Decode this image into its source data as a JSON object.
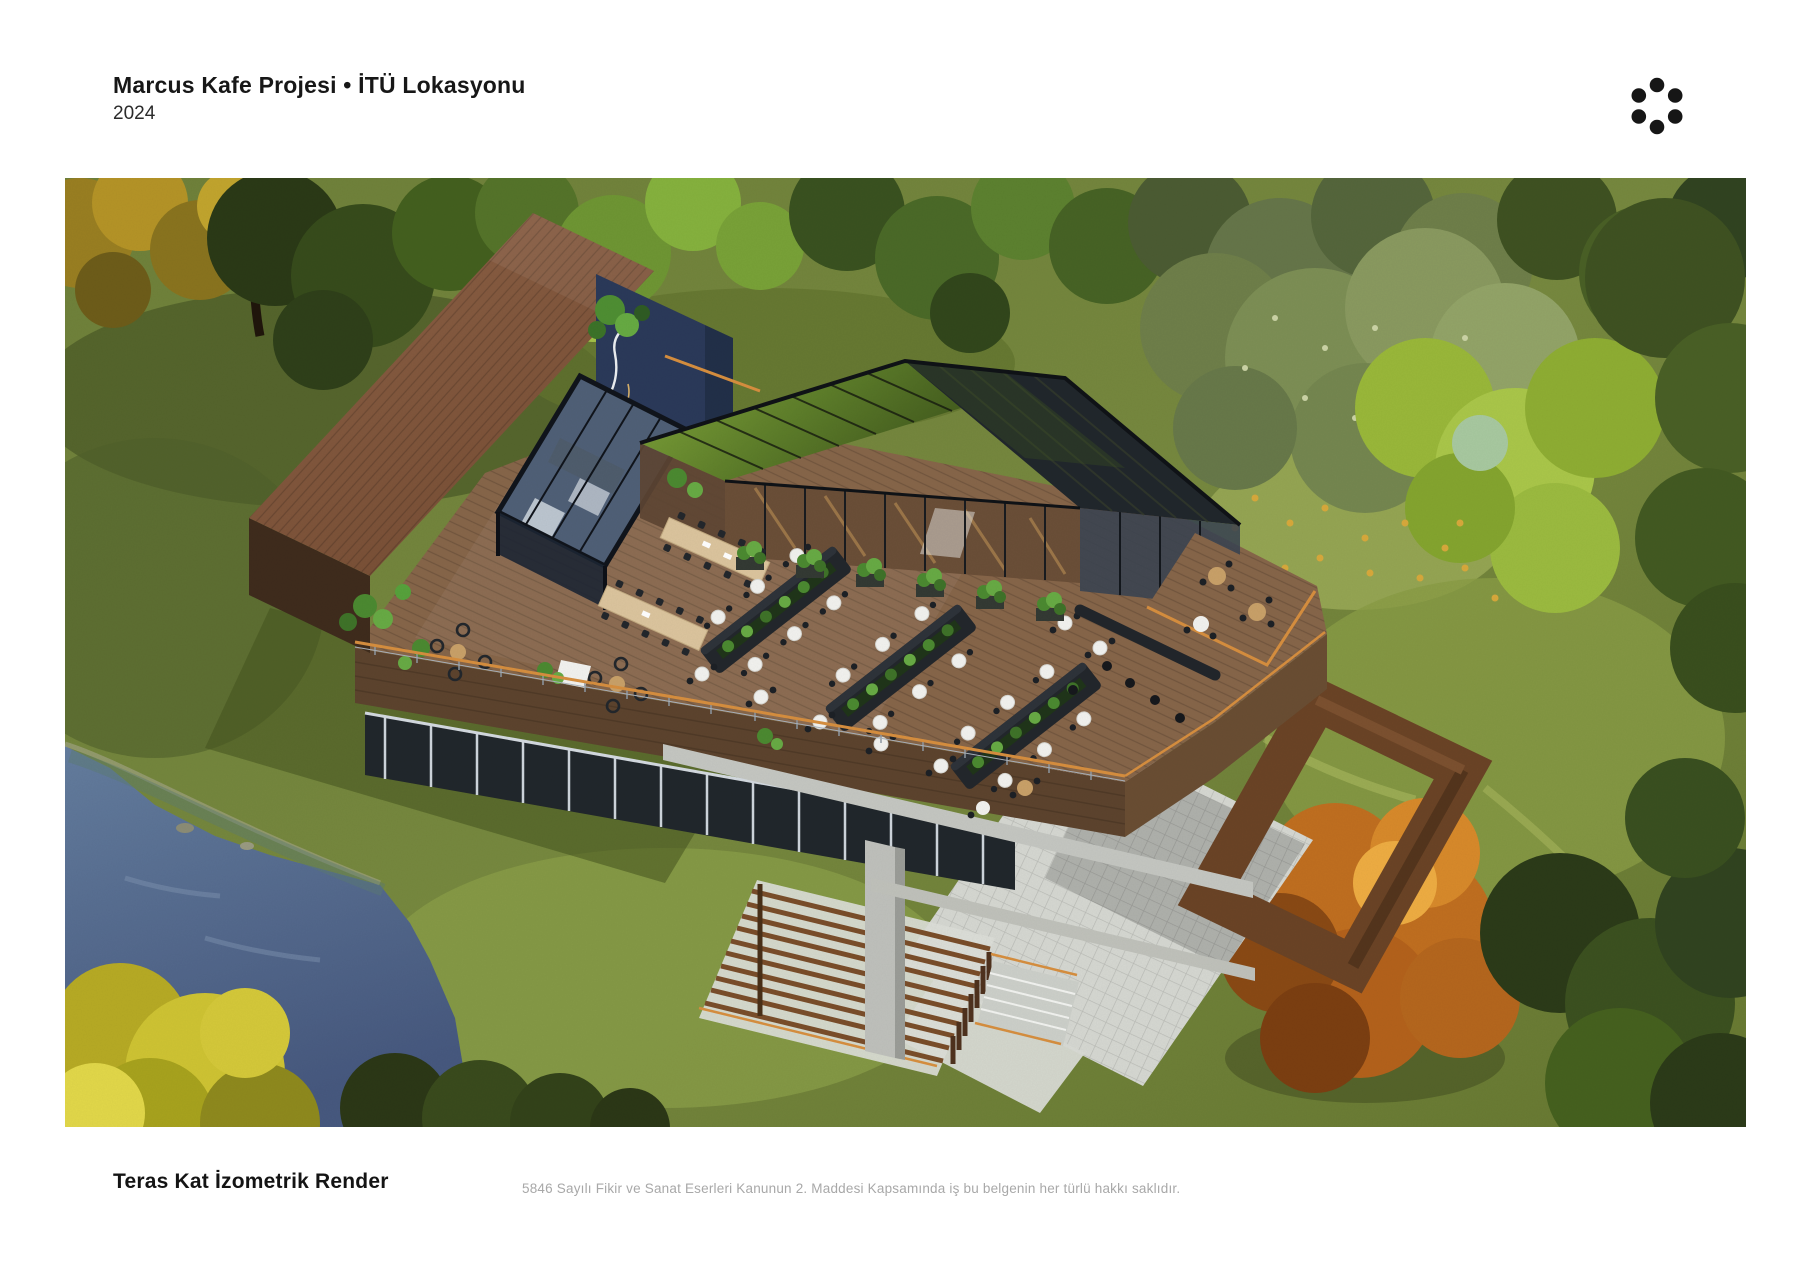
{
  "header": {
    "title": "Marcus Kafe Projesi • İTÜ Lokasyonu",
    "year": "2024"
  },
  "logo": {
    "style": "six-dot circular mark",
    "dot_count": 6
  },
  "figure": {
    "caption": "Teras Kat İzometrik Render",
    "disclaimer": "5846 Sayılı Fikir ve Sanat Eserleri Kanunun 2. Maddesi Kapsamında iş bu belgenin her türlü hakkı saklıdır."
  },
  "palette": {
    "page_bg": "#ffffff",
    "text_primary": "#171717",
    "text_muted": "#a8a8a8",
    "logo_color": "#161616",
    "grass": "#73853c",
    "grass_shadow": "#46541f",
    "water": "#546d94",
    "roof_wood": "#84593f",
    "deck_wood": "#87664a",
    "fascia_wood": "#5d442e",
    "sign_navy": "#2b3a5a",
    "canopy_green": "#6d9231",
    "glass_dark": "#21272c",
    "glass_amber": "#6b4f38",
    "paver": "#d6d8d2",
    "concrete": "#c5c7c2",
    "rail_accent": "#d78f3f",
    "autumn_orange": "#c06f20",
    "autumn_yellow": "#cfc433",
    "plant_green": "#4c8a31",
    "furniture_black": "#23272c",
    "table_light_wood": "#dcc59e"
  }
}
